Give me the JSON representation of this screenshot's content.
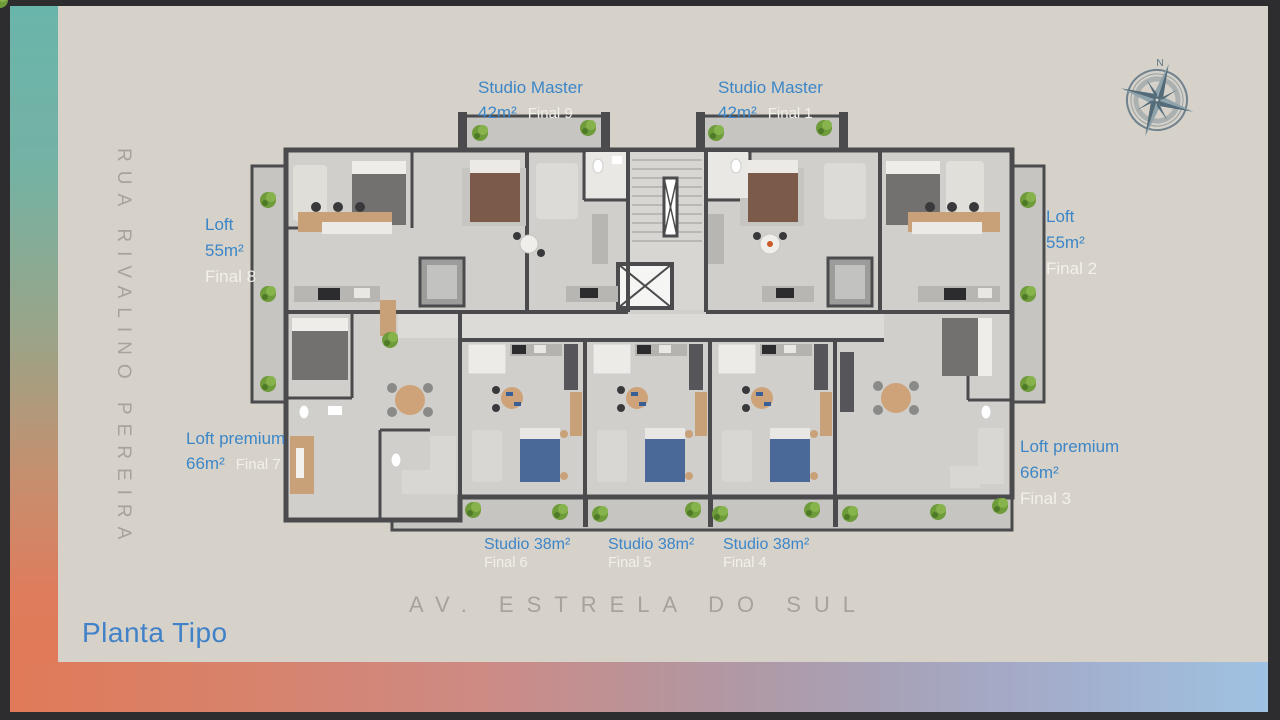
{
  "title": {
    "label": "Planta Tipo"
  },
  "streets": {
    "left": "RUA RIVALINO PEREIRA",
    "bottom": "AV. ESTRELA DO SUL"
  },
  "compass": {
    "north": "N"
  },
  "units": [
    {
      "name": "Studio Master",
      "area": "42m²",
      "final": "Final 9",
      "position": "top-left"
    },
    {
      "name": "Studio Master",
      "area": "42m²",
      "final": "Final 1",
      "position": "top-right"
    },
    {
      "name": "Loft",
      "area": "55m²",
      "final": "Final 8",
      "position": "left"
    },
    {
      "name": "Loft",
      "area": "55m²",
      "final": "Final 2",
      "position": "right"
    },
    {
      "name": "Loft premium",
      "area": "66m²",
      "final": "Final 7",
      "position": "bottom-left"
    },
    {
      "name": "Loft premium",
      "area": "66m²",
      "final": "Final 3",
      "position": "bottom-right"
    },
    {
      "name": "Studio",
      "area": "38m²",
      "final": "Final 6",
      "position": "bottom"
    },
    {
      "name": "Studio",
      "area": "38m²",
      "final": "Final 5",
      "position": "bottom"
    },
    {
      "name": "Studio",
      "area": "38m²",
      "final": "Final 4",
      "position": "bottom"
    }
  ],
  "colors": {
    "accent_blue": "#3c86c8",
    "label_white": "#f3f0ea",
    "street_gray": "#a7a29a",
    "canvas": "#d6d2ca",
    "frame_teal": "#6ab5ab",
    "frame_salmon": "#e07a58",
    "frame_blue": "#9fc2e2",
    "compass": "#5d7482",
    "wall": "#4b4b4d"
  }
}
